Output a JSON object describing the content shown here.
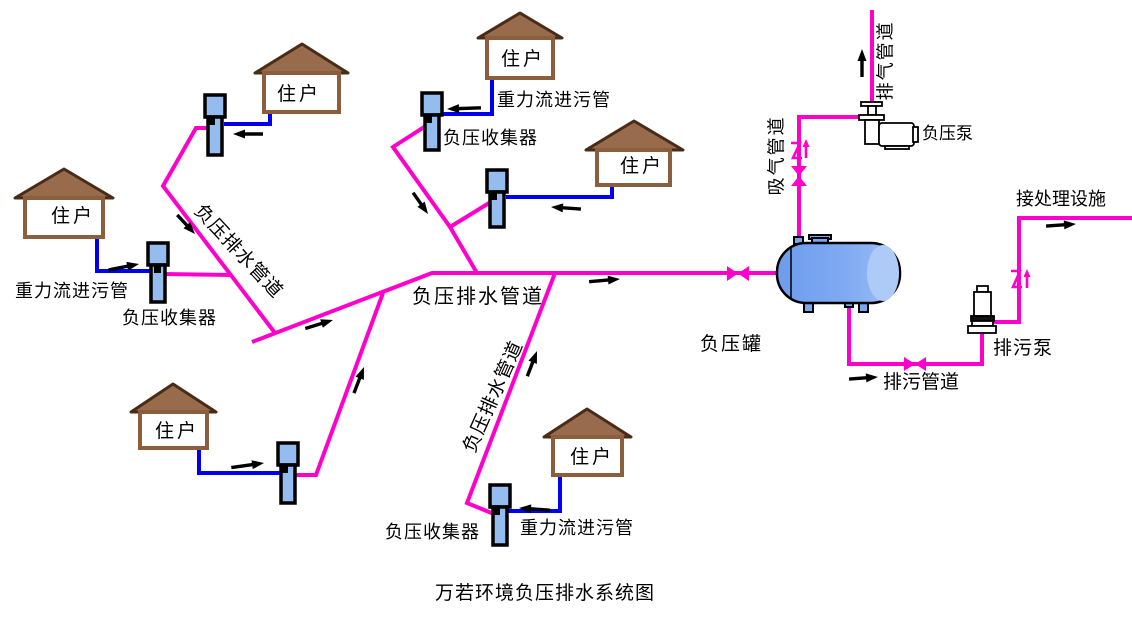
{
  "title": "万若环境负压排水系统图",
  "labels": {
    "house": "住户",
    "gravity_inlet_pipe": "重力流进污管",
    "vacuum_collector": "负压收集器",
    "vacuum_drain_pipe": "负压排水管道",
    "vacuum_tank": "负压罐",
    "vacuum_pump": "负压泵",
    "sewage_pump": "排污泵",
    "sewage_pipe": "排污管道",
    "suction_pipe": "吸气管道",
    "exhaust_pipe": "排气管道",
    "to_treatment": "接处理设施"
  },
  "colors": {
    "vacuum_pipe": "#FF00CC",
    "gravity_pipe": "#0000EE",
    "roof_fill": "#996B4D",
    "roof_border": "#4A2B15",
    "wall_border": "#8B5E3E",
    "collector_fill": "#94BCEE",
    "tank_fill": "#7AA6F2",
    "tank_cap": "#AECBF8",
    "arrow": "#000000"
  },
  "diagram": {
    "type": "process-flow",
    "house_count": 6,
    "collector_count": 6,
    "branch_count": 3,
    "flow_sequence": [
      "住户",
      "重力流进污管",
      "负压收集器",
      "负压排水管道",
      "负压罐",
      "排污泵",
      "排污管道",
      "接处理设施"
    ],
    "air_path": [
      "负压罐",
      "吸气管道",
      "负压泵",
      "排气管道"
    ],
    "valves": {
      "gate_valves": 3,
      "check_valves": 2
    }
  }
}
